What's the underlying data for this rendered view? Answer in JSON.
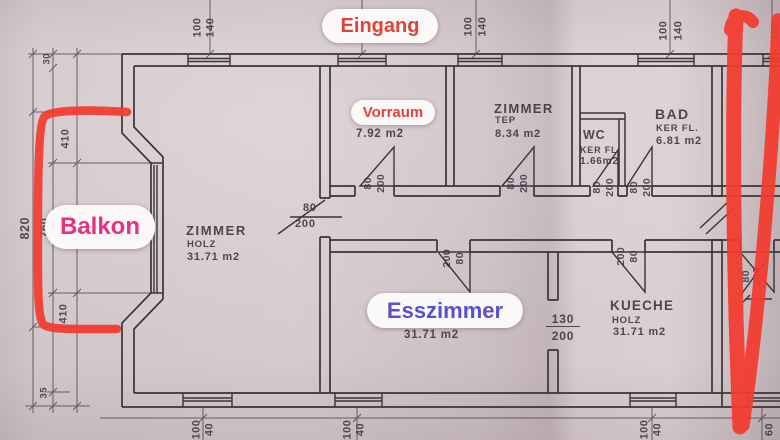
{
  "photo": {
    "type": "annotated floor plan photo",
    "annotations": {
      "eingang": "Eingang",
      "vorraum": "Vorraum",
      "balkon": "Balkon",
      "esszimmer": "Esszimmer"
    },
    "colors": {
      "marker_red": "#f43b2e",
      "eingang_text": "#e0423c",
      "vorraum_text": "#e0423c",
      "balkon_text": "#e73180",
      "esszimmer_text": "#5a50cc",
      "paper": "#d2c6c9",
      "plan_line": "#3a3539"
    }
  },
  "rooms": {
    "zimmer_left": {
      "name": "ZIMMER",
      "floor": "HOLZ",
      "area": "31.71 m2"
    },
    "vorraum": {
      "floor": "TEP",
      "area": "7.92 m2"
    },
    "zimmer_small": {
      "name": "ZIMMER",
      "floor": "TEP",
      "area": "8.34 m2"
    },
    "wc": {
      "name": "WC",
      "floor": "KER FL",
      "area": "1.66m2"
    },
    "bad": {
      "name": "BAD",
      "floor": "KER FL.",
      "area": "6.81 m2"
    },
    "esszimmer": {
      "area": "31.71 m2"
    },
    "kueche": {
      "name": "KUECHE",
      "floor": "HOLZ",
      "area": "31.71 m2"
    }
  },
  "dims": {
    "top_windows": [
      {
        "w": "100",
        "h": "140"
      },
      {
        "w": "100",
        "h": "140"
      },
      {
        "w": "100",
        "h": "140"
      },
      {
        "w": "100",
        "h": ""
      }
    ],
    "bottom_windows": [
      {
        "w": "100",
        "h": "40"
      },
      {
        "w": "100",
        "h": "40"
      },
      {
        "w": "100",
        "h": "40"
      },
      {
        "w": "60",
        "h": ""
      }
    ],
    "left": [
      "30",
      "410",
      "820",
      "760",
      "410",
      "35"
    ],
    "doors": {
      "vorraum": {
        "w": "80",
        "h": "200"
      },
      "zimmer_small": {
        "w": "80",
        "h": "200"
      },
      "wc": {
        "w": "80",
        "h": "200"
      },
      "bad": {
        "w": "80",
        "h": "200"
      },
      "zimmer_left": {
        "w": "80",
        "h": "200"
      },
      "esszimmer": {
        "w": "200",
        "h": "80"
      },
      "kueche": {
        "w": "200",
        "h": "80"
      },
      "east": {
        "w": "80",
        "h": "200"
      },
      "passage": {
        "w": "130",
        "h": "200"
      }
    }
  }
}
